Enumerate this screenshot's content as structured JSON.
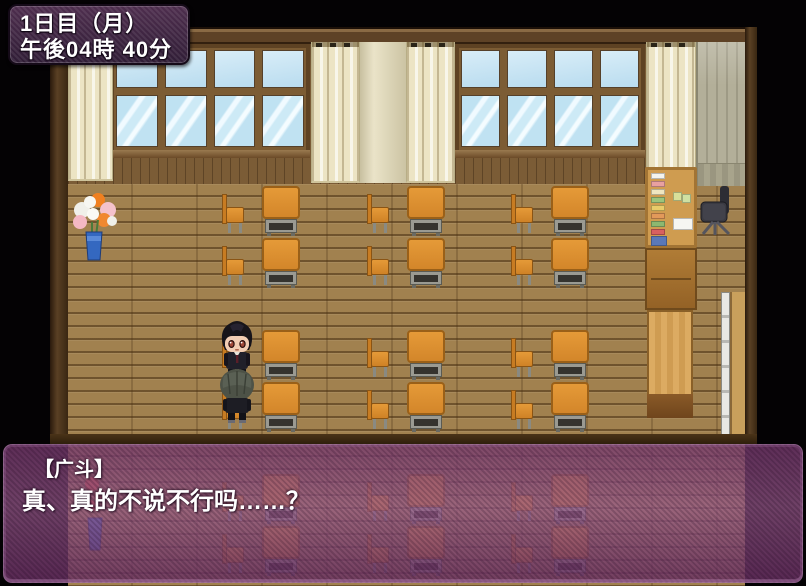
{
  "hud": {
    "time_box": {
      "day_label": "1日目（月）",
      "time_label": "午後04時 40分"
    }
  },
  "dialog": {
    "speaker_name": "【广斗】",
    "text": "真、真的不说不行吗……？"
  },
  "scene": {
    "description": "RPG classroom interior, afternoon",
    "objects": [
      "student-desk",
      "student-chair",
      "bulletin-board",
      "storage-cabinet",
      "teacher-table",
      "office-chair",
      "flower-vase",
      "sliding-door",
      "window",
      "curtain",
      "character-hiroto-front",
      "character-back-view"
    ],
    "colors": {
      "desk_orange": "#d3862a",
      "floor_brown": "#a1814f",
      "wall_brown": "#7b5c36",
      "curtain_cream": "#ece4c4",
      "window_blue": "#bfe2f2",
      "hud_purple": "#3e2542",
      "dialog_purple": "#8c5280",
      "outside_black": "#040204"
    }
  },
  "layout": {
    "desk_groups_row_tops": [
      [
        186,
        238
      ],
      [
        330,
        382
      ],
      [
        474,
        526
      ]
    ],
    "desk_column_lefts": [
      262,
      407,
      551
    ],
    "chair_column_lefts": [
      222,
      367,
      511
    ]
  }
}
